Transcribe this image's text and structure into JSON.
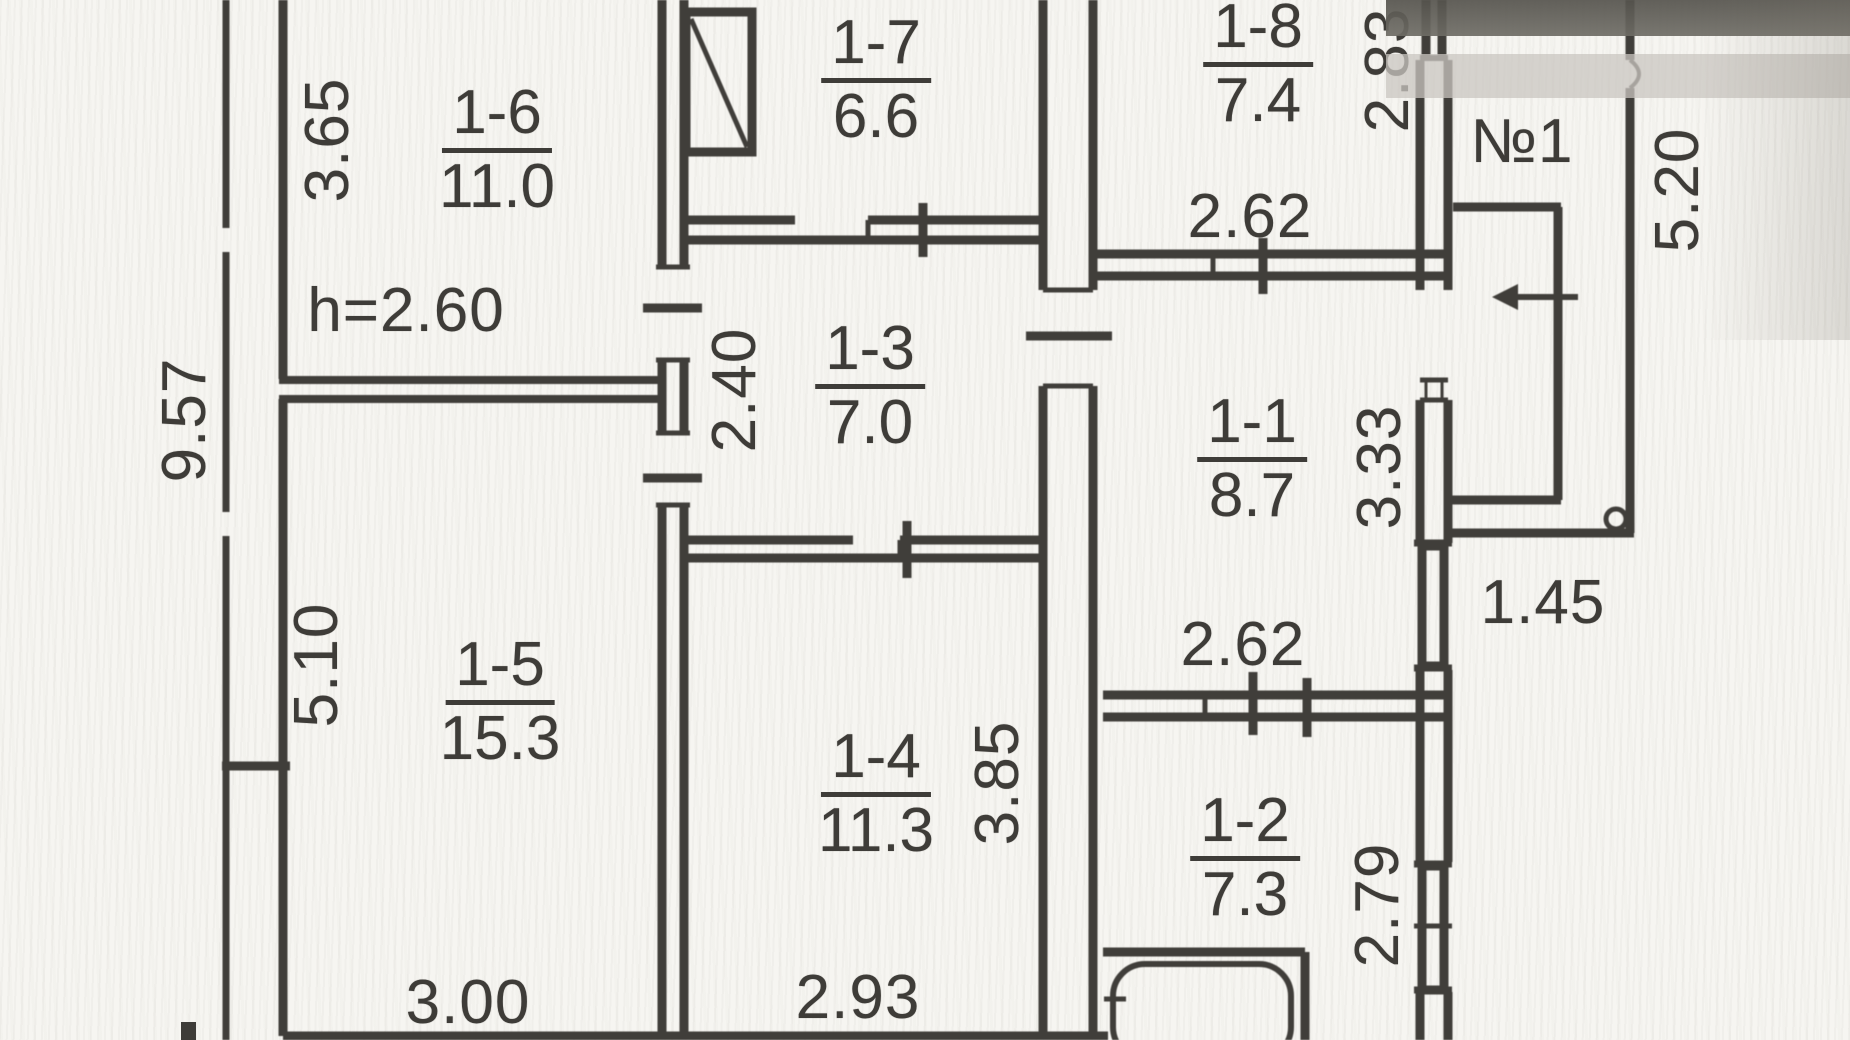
{
  "plan": {
    "ceiling_height": "h=2.60",
    "entrance_mark": "№1",
    "rooms": [
      {
        "id": "1-1",
        "area": "8.7"
      },
      {
        "id": "1-2",
        "area": "7.3"
      },
      {
        "id": "1-3",
        "area": "7.0"
      },
      {
        "id": "1-4",
        "area": "11.3"
      },
      {
        "id": "1-5",
        "area": "15.3"
      },
      {
        "id": "1-6",
        "area": "11.0"
      },
      {
        "id": "1-7",
        "area": "6.6"
      },
      {
        "id": "1-8",
        "area": "7.4"
      }
    ],
    "dimensions": {
      "total_left": "9.57",
      "r16_depth": "3.65",
      "r15_depth": "5.10",
      "r15_width": "3.00",
      "hall_depth": "2.40",
      "r14_width": "2.93",
      "r14_depth": "3.85",
      "r18_depth": "2.83",
      "r18_width": "2.62",
      "r11_depth": "3.33",
      "porch_width": "1.45",
      "r12_width": "2.62",
      "r12_depth": "2.79",
      "right_total": "5.20"
    }
  }
}
